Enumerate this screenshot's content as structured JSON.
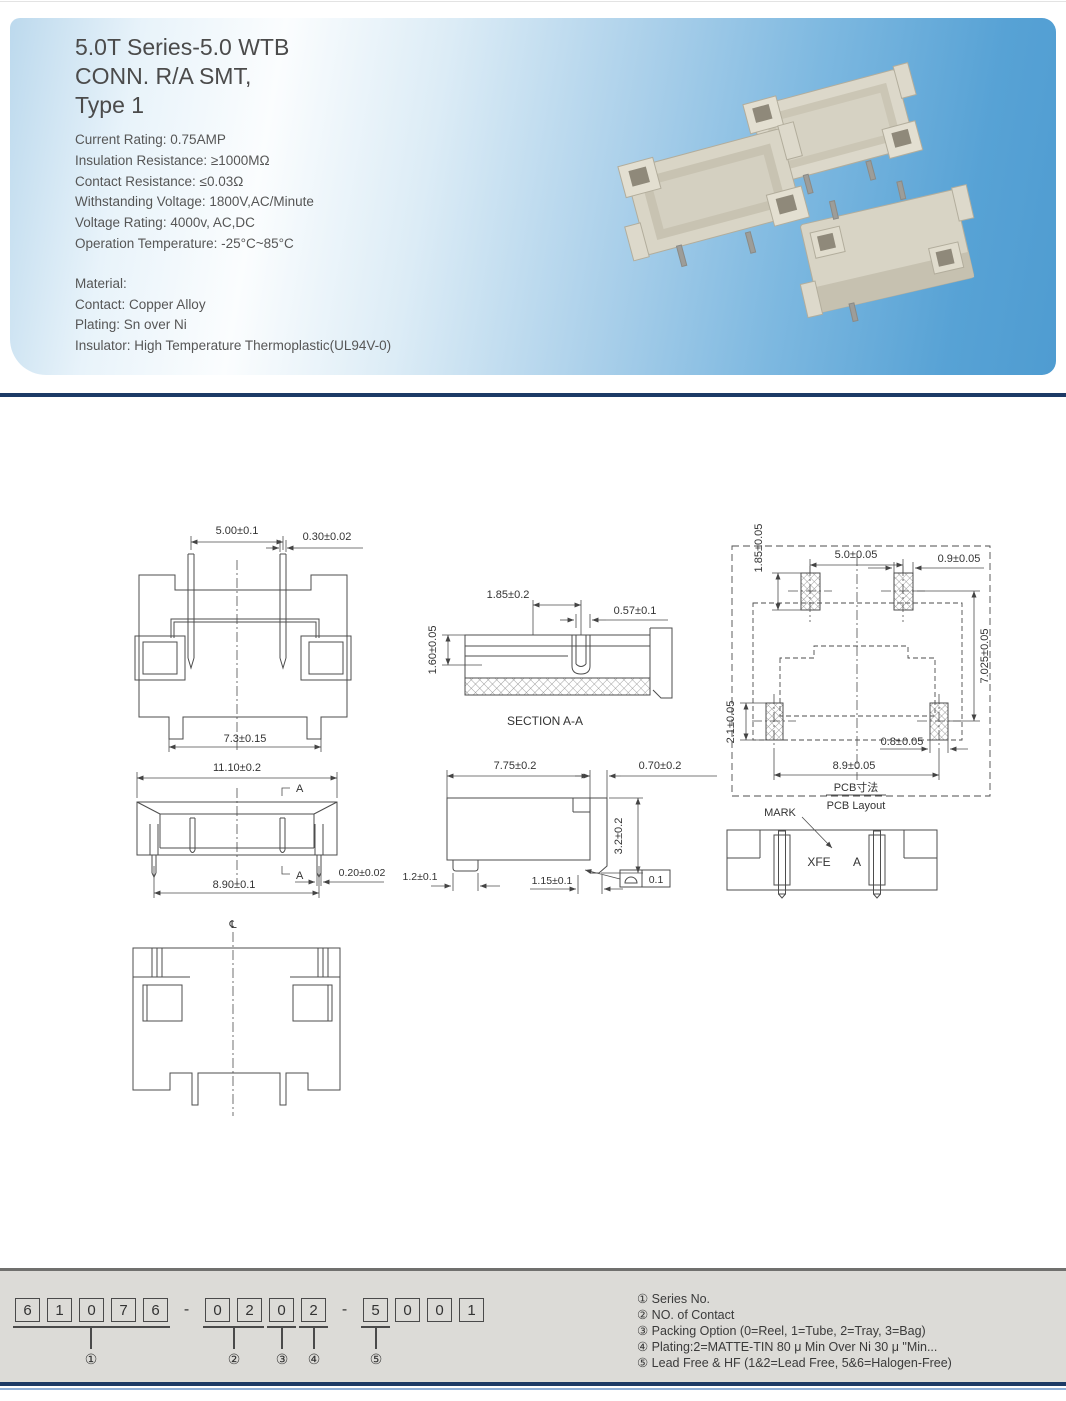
{
  "header": {
    "title_lines": [
      "5.0T Series-5.0 WTB",
      "CONN. R/A SMT,",
      "Type 1"
    ],
    "specs": [
      "Current Rating: 0.75AMP",
      "Insulation Resistance: ≥1000MΩ",
      "Contact Resistance: ≤0.03Ω",
      "Withstanding Voltage: 1800V,AC/Minute",
      "Voltage Rating: 4000v, AC,DC",
      "Operation Temperature: -25°C~85°C"
    ],
    "material": [
      "Material:",
      "Contact: Copper Alloy",
      "Plating: Sn over Ni",
      "Insulator: High Temperature Thermoplastic(UL94V-0)"
    ],
    "accent_navy": "#1c3a66",
    "photo_blue": "#519ed3",
    "connector_beige": "#dcd8ca"
  },
  "drawings": {
    "front": {
      "dim_pitch": "5.00±0.1",
      "dim_pin": "0.30±0.02",
      "dim_body": "7.3±0.15"
    },
    "section": {
      "dim_slot": "1.85±0.2",
      "dim_pin": "0.57±0.1",
      "dim_height": "1.60±0.05",
      "label": "SECTION A-A"
    },
    "pcb": {
      "dim_pad_len_top": "1.85±0.05",
      "dim_pitch": "5.0±0.05",
      "dim_pad_w_top": "0.9±0.05",
      "dim_row": "7.025±0.05",
      "dim_pad_len_bot": "2.1±0.05",
      "dim_pad_w_bot": "0.8±0.05",
      "dim_span": "8.9±0.05",
      "label_cn": "PCB寸法",
      "label_en": "PCB Layout"
    },
    "top": {
      "dim_total": "11.10±0.2",
      "dim_span": "8.90±0.1",
      "dim_pin": "0.20±0.02",
      "section_a": "A"
    },
    "side": {
      "dim_depth": "7.75±0.2",
      "dim_tail": "0.70±0.2",
      "dim_height": "3.2±0.2",
      "dim_foot": "1.2±0.1",
      "dim_pad": "1.15±0.1",
      "flatness": "0.1"
    },
    "mark": {
      "label": "MARK",
      "marking": "XFE",
      "pos": "A"
    },
    "bottom": {
      "centerline": "℄"
    }
  },
  "part_number": {
    "digits": [
      "6",
      "1",
      "0",
      "7",
      "6",
      "0",
      "2",
      "0",
      "2",
      "5",
      "0",
      "0",
      "1"
    ],
    "dash1": "-",
    "dash2": "-",
    "group_labels": [
      "①",
      "②",
      "③",
      "④",
      "⑤"
    ]
  },
  "legend": {
    "items": [
      "① Series No.",
      "② NO. of Contact",
      "③ Packing Option (0=Reel, 1=Tube, 2=Tray, 3=Bag)",
      "④ Plating:2=MATTE-TIN 80 μ Min Over Ni 30 μ \"Min...",
      "⑤ Lead Free & HF (1&2=Lead Free, 5&6=Halogen-Free)"
    ]
  }
}
